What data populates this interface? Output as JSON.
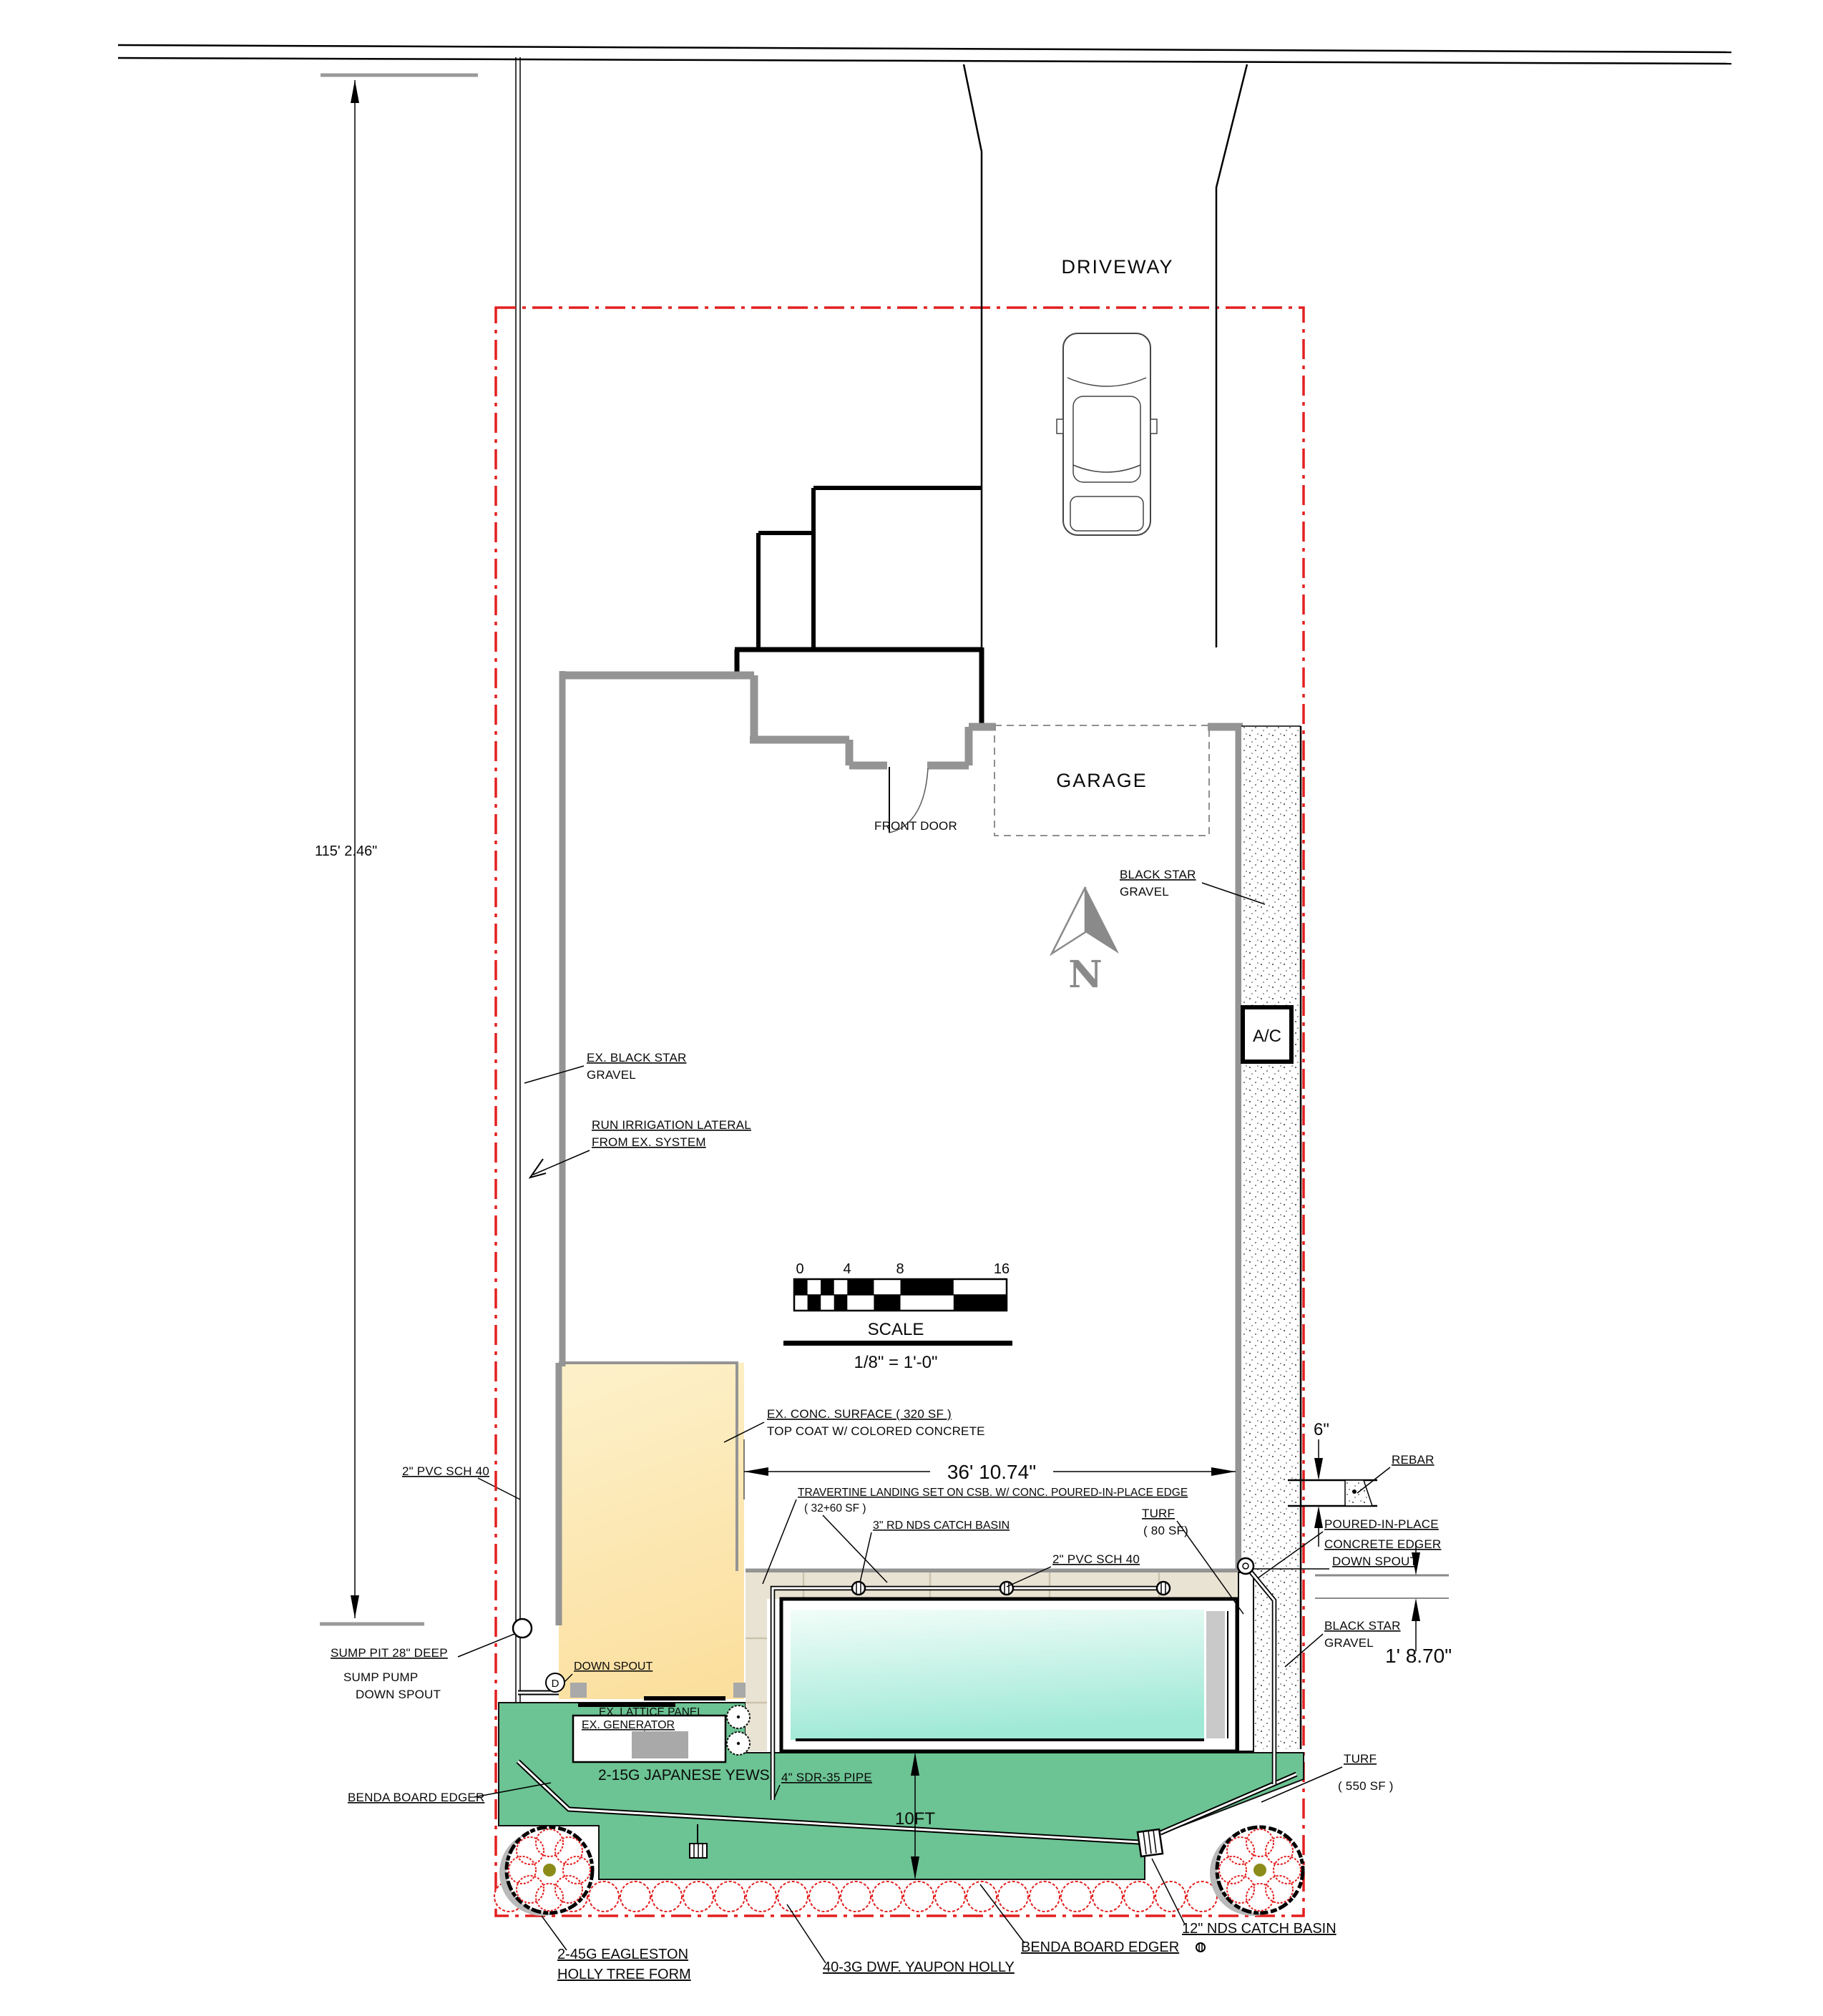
{
  "plan": {
    "driveway": "DRIVEWAY",
    "garage": "GARAGE",
    "front_door": "FRONT DOOR",
    "ac": "A/C",
    "north": "N"
  },
  "dimensions": {
    "lot_depth": "115' 2.46\"",
    "pool_width": "36' 10.74\"",
    "edger_width": "6\"",
    "gravel_width": "1' 8.70\"",
    "turf_depth": "10FT"
  },
  "scale_bar": {
    "title": "SCALE",
    "ratio": "1/8\" = 1'-0\"",
    "ticks": [
      "0",
      "4",
      "8",
      "16"
    ]
  },
  "labels": {
    "black_star_gravel_1a": "BLACK STAR",
    "black_star_gravel_1b": "GRAVEL",
    "ex_gravel_a": "EX. BLACK STAR",
    "ex_gravel_b": "GRAVEL",
    "irrigation_a": "RUN IRRIGATION LATERAL",
    "irrigation_b": "FROM EX. SYSTEM",
    "ex_conc_a": "EX. CONC. SURFACE ( 320 SF )",
    "ex_conc_b": "TOP COAT W/ COLORED CONCRETE",
    "travertine_a": "TRAVERTINE LANDING SET ON CSB. W/ CONC. POURED-IN-PLACE EDGE",
    "travertine_b": "( 32+60 SF )",
    "catch_basin_3": "3\" RD NDS CATCH BASIN",
    "turf80_a": "TURF",
    "turf80_b": "( 80 SF)",
    "pvc_right": "2\" PVC SCH 40",
    "pvc_left": "2\" PVC SCH 40",
    "rebar": "REBAR",
    "pip_a": "POURED-IN-PLACE",
    "pip_b": "CONCRETE EDGER",
    "downspout_right": "DOWN SPOUT",
    "bsg_right_a": "BLACK STAR",
    "bsg_right_b": "GRAVEL",
    "sump_a": "SUMP PIT 28\" DEEP",
    "sump_b": "SUMP PUMP",
    "sump_c": "DOWN SPOUT",
    "downspout_mid": "DOWN SPOUT",
    "downspout_d": "D",
    "lattice": "EX. LATTICE PANEL",
    "generator": "EX. GENERATOR",
    "yews": "2-15G JAPANESE YEWS",
    "sdr35": "4\" SDR-35 PIPE",
    "benda_left": "BENDA BOARD EDGER",
    "turf550_a": "TURF",
    "turf550_b": "( 550 SF )",
    "eagleston_a": "2-45G EAGLESTON",
    "eagleston_b": "HOLLY TREE FORM",
    "yaupon": "40-3G DWF. YAUPON HOLLY",
    "benda_bottom": "BENDA BOARD EDGER",
    "catch_basin_12": "12\" NDS CATCH BASIN"
  },
  "colors": {
    "turf_green": "#6cc393",
    "pool_teal": "#9fe9d6",
    "concrete_yellow": "#fbdf9e",
    "travertine": "#e9e3d4",
    "boundary_red": "#e31f1f",
    "wall_gray": "#949494",
    "tree_center_olive": "#8b8b1a"
  }
}
